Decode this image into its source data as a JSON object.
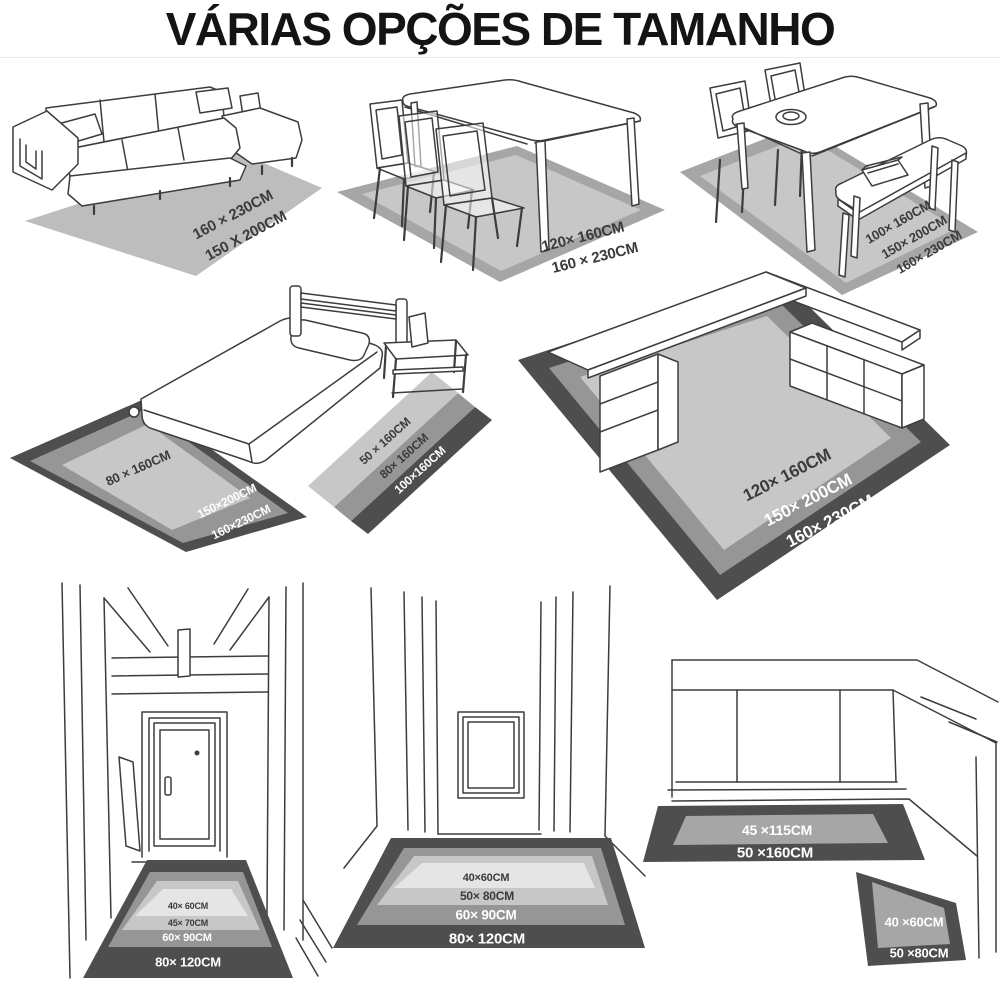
{
  "title": "VÁRIAS OPÇÕES DE TAMANHO",
  "scenes": {
    "sofa": {
      "sizes": [
        "160 × 230CM",
        "150 X 200CM"
      ]
    },
    "dining_table": {
      "sizes": [
        "120× 160CM",
        "160 × 230CM"
      ]
    },
    "dining_bench": {
      "sizes": [
        "100× 160CM",
        "150× 200CM",
        "160× 230CM"
      ]
    },
    "bed": {
      "foot_rug": {
        "inner": "80 × 160CM",
        "border": [
          "150×200CM",
          "160×230CM"
        ]
      },
      "side_rug": {
        "sizes": [
          "50 × 160CM",
          "80× 160CM",
          "100×160CM"
        ]
      }
    },
    "desk": {
      "sizes": [
        "120× 160CM",
        "150× 200CM",
        "160× 230CM"
      ]
    },
    "hallway_door": {
      "sizes": [
        "40× 60CM",
        "45× 70CM",
        "60× 90CM",
        "80× 120CM"
      ]
    },
    "corridor": {
      "sizes": [
        "40×60CM",
        "50× 80CM",
        "60× 90CM",
        "80× 120CM"
      ]
    },
    "kitchen": {
      "counter_rug": {
        "sizes": [
          "45 ×115CM",
          "50 ×160CM"
        ]
      },
      "corner_rug": {
        "sizes": [
          "40 ×60CM",
          "50 ×80CM"
        ]
      }
    }
  },
  "colors": {
    "ink": "#3d3d3d",
    "title": "#141414",
    "rug_sofa": "#bdbdbd",
    "rug_pale": "#e5e5e5",
    "rug_light": "#c7c7c7",
    "rug_mid": "#969696",
    "rug_dark": "#4e4e4e",
    "rug_border_gray": "#a6a6a6",
    "label_dark": "#3b3b3b",
    "label_light": "#ffffff"
  }
}
